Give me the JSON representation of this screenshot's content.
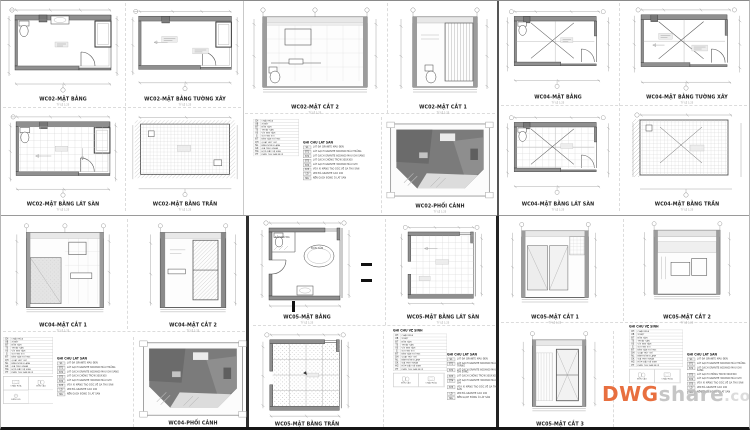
{
  "sheet": {
    "scale_note": "TỶ LỆ 1:25",
    "titles": {
      "wc02_mb": "WC02-MẶT BẰNG",
      "wc02_mb_tx": "WC02-MẶT BẰNG TƯỜNG XÂY",
      "wc02_mb_ls": "WC02-MẶT BẰNG LÁT SÀN",
      "wc02_mb_tr": "WC02-MẶT BẰNG TRẦN",
      "wc02_mc2": "WC02-MẶT CẮT 2",
      "wc02_mc1": "WC02-MẶT CẮT 1",
      "wc02_pc": "WC02-PHỐI CẢNH",
      "wc04_mb": "WC04-MẶT BẰNG",
      "wc04_mb_tx": "WC04-MẶT BẰNG TƯỜNG XÂY",
      "wc04_mb_ls": "WC04-MẶT BẰNG LÁT SÀN",
      "wc04_mb_tr": "WC04-MẶT BẰNG TRẦN",
      "wc04_mc1": "WC04-MẶT CẮT 1",
      "wc04_mc2": "WC04-MẶT CẮT 2",
      "wc04_pc": "WC04-PHỐI CẢNH",
      "wc05_mb": "WC05-MẶT BẰNG",
      "wc05_mb_ls": "WC05-MẶT BẰNG LÁT SÀN",
      "wc05_mb_tr": "WC05-MẶT BẰNG TRẦN",
      "wc05_mc1": "WC05-MẶT CẮT 1",
      "wc05_mc2": "WC05-MẶT CẮT 2",
      "wc05_mc3": "WC05-MẶT CẮT 3"
    },
    "room_labels": {
      "tam_dung": "TẮM ĐỨNG",
      "bon_tam": "BỒN TẮM"
    },
    "legend_vs": {
      "title": "GHI CHÚ VỆ SINH",
      "rows": [
        {
          "c": "CH",
          "l": "CHẬU RỬA"
        },
        {
          "c": "XB",
          "l": "XÍ BỆT"
        },
        {
          "c": "BT",
          "l": "BỒN TẮM"
        },
        {
          "c": "TS",
          "l": "THOÁT SÀN"
        },
        {
          "c": "VS",
          "l": "VÒI SEN TẮM"
        },
        {
          "c": "G",
          "l": "GƯƠNG SOI"
        },
        {
          "c": "ĐT",
          "l": "ĐÈN GẮN TƯỜNG"
        },
        {
          "c": "QH",
          "l": "QUẠT HÚT GIÓ"
        },
        {
          "c": "NL",
          "l": "BÌNH NÓNG LẠNH"
        },
        {
          "c": "GK",
          "l": "GIÁ TREO KHĂN"
        },
        {
          "c": "HG",
          "l": "HỘP GIẤY VỆ SINH"
        },
        {
          "c": "PT",
          "l": "PHỄU THU SÀN INOX"
        }
      ]
    },
    "legend_ls": {
      "title": "GHI CHÚ LÁT SÀN",
      "rows": [
        {
          "c": "S1",
          "l": "LÁT ĐÁ GRANITE MÀU ĐEN"
        },
        {
          "c": "ST1",
          "l": "LÁT GẠCH GRANITE 600X600 MÀU TRẮNG"
        },
        {
          "c": "ST2",
          "l": "LÁT GẠCH GRANITE 600X600 MÀU GHI SÁNG"
        },
        {
          "c": "ST3",
          "l": "LÁT GẠCH CHỐNG TRƠN 300X300"
        },
        {
          "c": "ST4",
          "l": "LÁT GẠCH GRANITE 300X600 MÀU GHI"
        },
        {
          "c": "ST5",
          "l": "VỮA XI MĂNG TẠO DỐC VỀ GA THU SÀN"
        },
        {
          "c": "LD",
          "l": "LEN ĐÁ GRANITE CAO 100"
        },
        {
          "c": "NG",
          "l": "NỀN GẠCH ĐÓNG Ô LÁT SÀN"
        }
      ]
    },
    "legend_icons": {
      "chau_rua": "CHẬU RỬA",
      "bon_cau": "BỒN CẦU",
      "den_led": "ĐÈN LED"
    },
    "watermark": {
      "prefix": "DWG",
      "suffix": "share",
      "domain": ".com"
    },
    "colors": {
      "watermark_orange": "#E86F3F",
      "watermark_gray": "#B9B9B9",
      "line": "#555555",
      "wall_fill": "#8F8F8F",
      "perspective_fill": "#7B7B7B",
      "background": "#FFFFFF"
    }
  }
}
